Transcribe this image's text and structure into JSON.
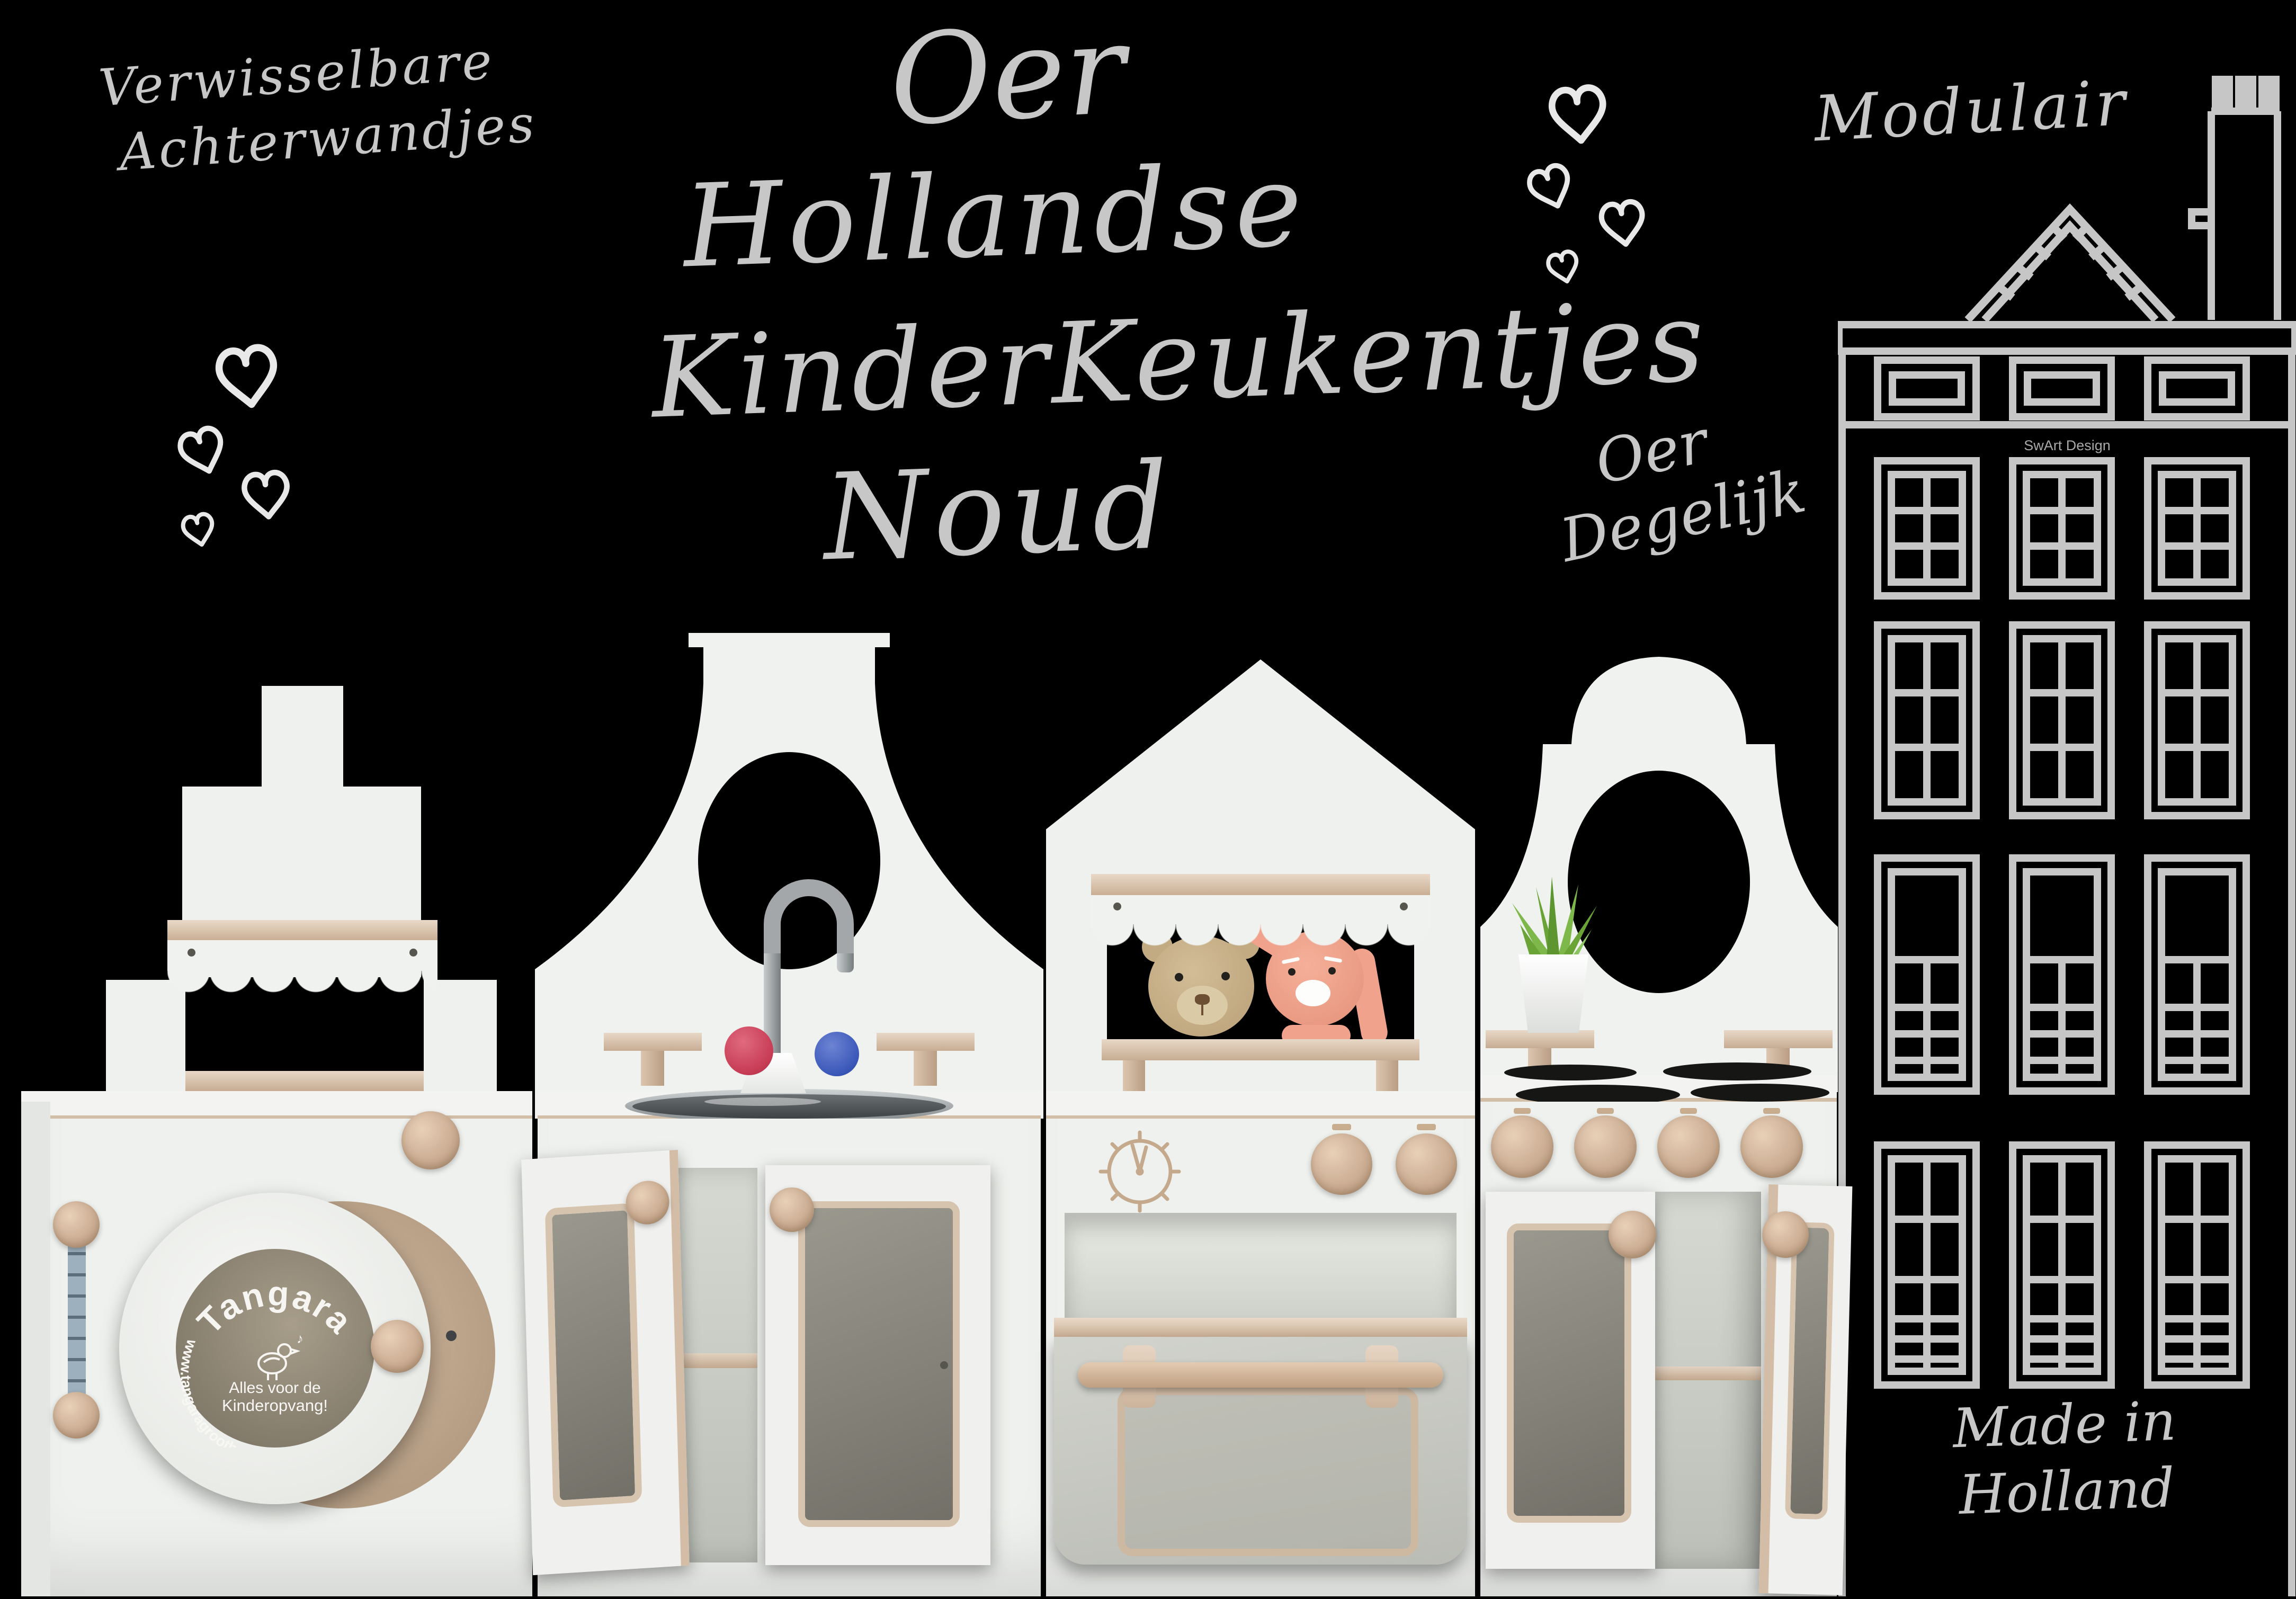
{
  "poster": {
    "background_color": "#000000",
    "chalk_color": "#c7c7c7",
    "house_line_color": "#c6c6c6"
  },
  "chalk": {
    "backwalls_note": {
      "line1": "Verwisselbare",
      "line2": "Achterwandjes"
    },
    "title": {
      "line1": "Oer",
      "line2": "Hollandse",
      "line3": "KinderKeukentjes",
      "line4": "Noud"
    },
    "modular_note": "Modulair",
    "sturdy_note": {
      "line1": "Oer",
      "line2": "Degelijk"
    },
    "made_in": {
      "line1": "Made in",
      "line2": "Holland"
    }
  },
  "house": {
    "credit": "SwArt Design"
  },
  "washer_door_logo": {
    "brand": "Tangara",
    "tagline_line1": "Alles voor de",
    "tagline_line2": "Kinderopvang!",
    "website": "www.tangaragroothandel.nl"
  },
  "kitchen": {
    "hot_knob_color": "#c63b54",
    "cold_knob_color": "#3a57b8",
    "wood_color": "#d7c3ae",
    "panel_color": "#eff1ee"
  }
}
